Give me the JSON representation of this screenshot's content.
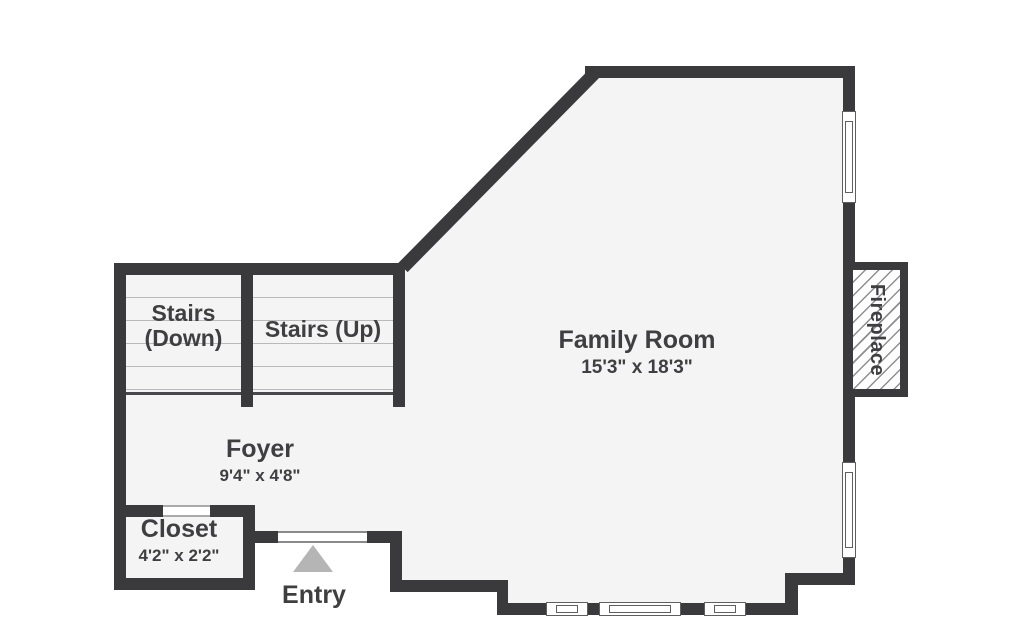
{
  "rooms": {
    "stairs_down": {
      "line1": "Stairs",
      "line2": "(Down)"
    },
    "stairs_up": {
      "label": "Stairs (Up)"
    },
    "family_room": {
      "label": "Family Room",
      "dims": "15'3\" x 18'3\""
    },
    "foyer": {
      "label": "Foyer",
      "dims": "9'4\" x 4'8\""
    },
    "closet": {
      "label": "Closet",
      "dims": "4'2\" x 2'2\""
    },
    "entry": {
      "label": "Entry"
    },
    "fireplace": {
      "label": "Fireplace"
    }
  },
  "colors": {
    "wall": "#3a3a3c",
    "floor": "#f4f4f5",
    "background": "#ffffff",
    "stair_tread": "#b9b9b9",
    "window_frame": "#5f5f61",
    "entry_arrow": "#b5b5b6",
    "text": "#3f3f42"
  }
}
